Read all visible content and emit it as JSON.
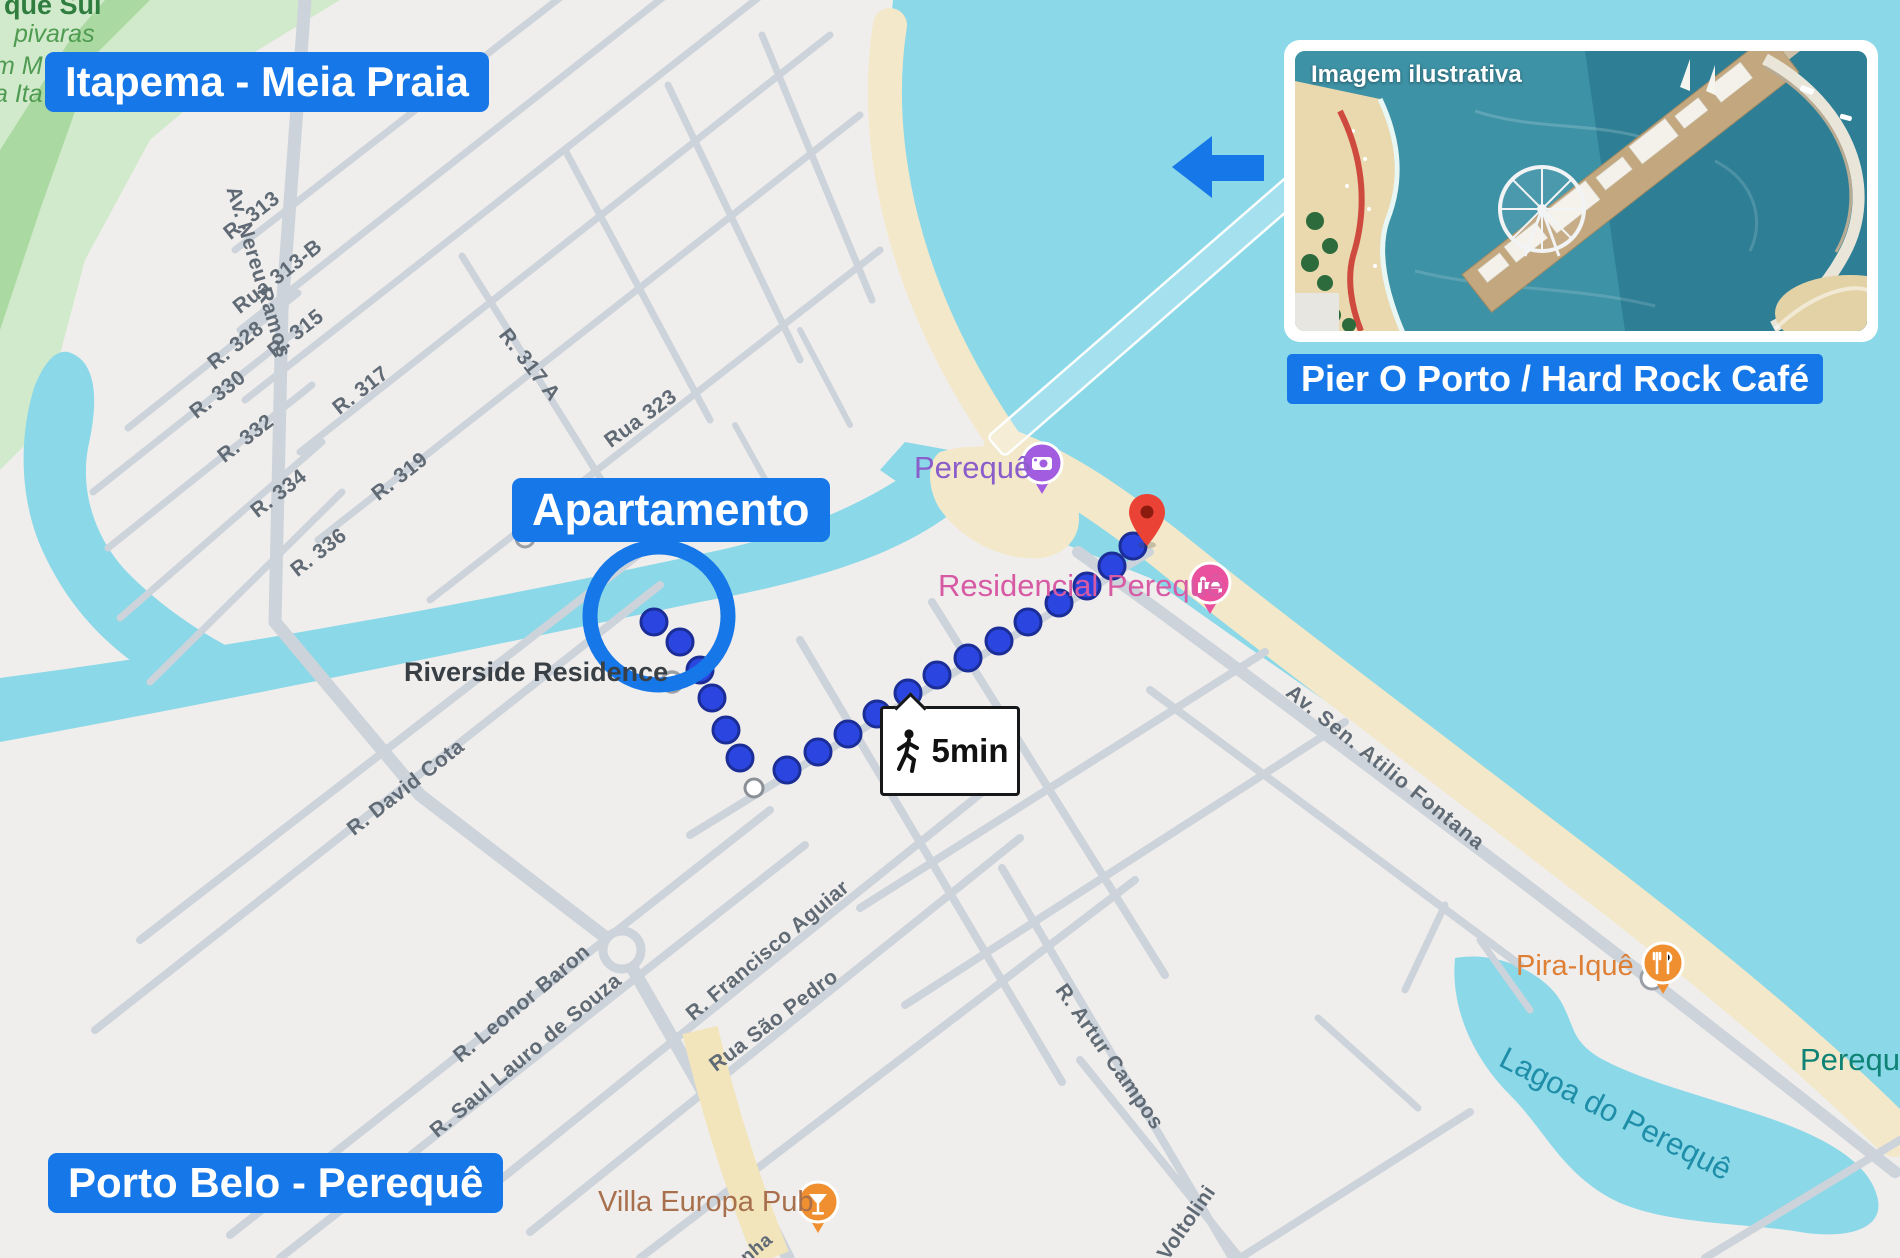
{
  "title_labels": {
    "itapema": "Itapema - Meia Praia",
    "apartamento": "Apartamento",
    "porto_belo": "Porto Belo - Perequê",
    "pier": "Pier O Porto / Hard Rock Café"
  },
  "inset": {
    "caption": "Imagem ilustrativa"
  },
  "route": {
    "duration_label": "5min"
  },
  "pois": {
    "pereque_beach": "Perequê",
    "residencial_pereque": "Residencial Perequê",
    "riverside_residence": "Riverside Residence",
    "pira_ique": "Pira-Iquê",
    "villa_europa_pub": "Villa Europa Pub",
    "lagoa_do_pereque": "Lagoa do Perequê",
    "pereque_locality": "Perequê"
  },
  "park_labels": {
    "line1": "que Sul",
    "line2": "pivaras",
    "line3": "m M",
    "line4": "a Ita"
  },
  "streets": [
    {
      "name": "Av. Nereu Ramos"
    },
    {
      "name": "R. 313"
    },
    {
      "name": "Rua 313-B"
    },
    {
      "name": "R. 315"
    },
    {
      "name": "R. 317"
    },
    {
      "name": "R. 319"
    },
    {
      "name": "R. 317 A"
    },
    {
      "name": "Rua 323"
    },
    {
      "name": "R. 328"
    },
    {
      "name": "R. 330"
    },
    {
      "name": "R. 332"
    },
    {
      "name": "R. 334"
    },
    {
      "name": "R. 336"
    },
    {
      "name": "R. David Cota"
    },
    {
      "name": "R. Leonor Baron"
    },
    {
      "name": "R. Saul Lauro de Souza"
    },
    {
      "name": "R. Francisco Aguiar"
    },
    {
      "name": "Rua São Pedro"
    },
    {
      "name": "R. Artur Campos"
    },
    {
      "name": "Voltolini"
    },
    {
      "name": "Av. Sen. Atilio Fontana"
    },
    {
      "name": "nha"
    }
  ],
  "colors": {
    "annotation_blue": "#1677e8",
    "water": "#8bd8e8",
    "sand": "#f3e8c9",
    "land": "#f0eeec",
    "street_gray": "#ccd3da",
    "route_dot": "#2b46e0",
    "route_dot_border": "#1b2d96",
    "destination_pin_red": "#ea4335",
    "photo_spot_pin_purple": "#a15ce0",
    "lodging_pin_pink": "#e9519e",
    "food_pin_orange": "#ef8f2f",
    "park_green": "#d2eacc",
    "water_label_teal": "#1f8ea9"
  }
}
